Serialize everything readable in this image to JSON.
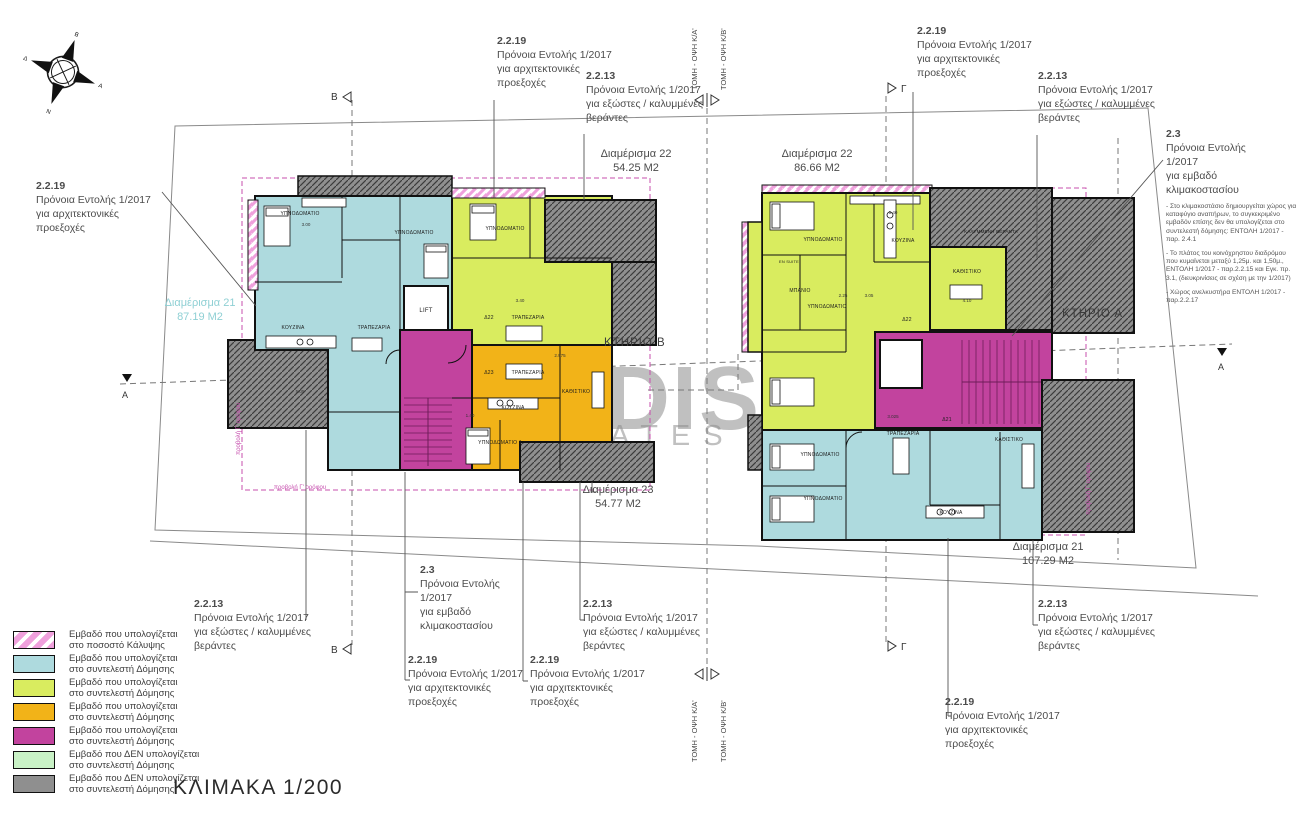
{
  "scale_label": "ΚΛΙΜΑΚΑ 1/200",
  "watermark": {
    "line1": "NDIS",
    "line2": "ATES"
  },
  "colors": {
    "teal": "#aedade",
    "lime": "#d9ec5f",
    "orange": "#f2b318",
    "magenta": "#c2439e",
    "light_green": "#c9f2c6",
    "gray": "#8f8f8f",
    "pink_hatch": "#efa0dc",
    "magenta_dash": "#c74fae",
    "teal_label": "#8fd0d4"
  },
  "compass": {
    "n": "Β",
    "e": "Α",
    "s": "Ν",
    "w": "Δ"
  },
  "buildings": {
    "left": "ΚΤΗΡΙΟ Β",
    "right": "ΚΤΗΡΙΟ Α"
  },
  "apartments": {
    "left_21": {
      "name": "Διαμέρισμα 21",
      "area": "87.19 M2"
    },
    "left_22": {
      "name": "Διαμέρισμα 22",
      "area": "54.25 M2"
    },
    "left_23": {
      "name": "Διαμέρισμα 23",
      "area": "54.77 M2"
    },
    "right_22": {
      "name": "Διαμέρισμα 22",
      "area": "86.66 M2"
    },
    "right_21": {
      "name": "Διαμέρισμα 21",
      "area": "107.29 M2"
    }
  },
  "annotations": {
    "a2219": {
      "code": "2.2.19",
      "lines": [
        "Πρόνοια Εντολής 1/2017",
        "για αρχιτεκτονικές",
        "προεξοχές"
      ]
    },
    "a2213": {
      "code": "2.2.13",
      "lines": [
        "Πρόνοια Εντολής 1/2017",
        "για εξώστες / καλυμμένες",
        "βεράντες"
      ]
    },
    "a23": {
      "code": "2.3",
      "lines": [
        "Πρόνοια Εντολής",
        "1/2017",
        "για εμβαδό",
        "κλιμακοστασίου"
      ]
    },
    "a23_notes": [
      "- Στο κλιμακοστάσιο δημιουργείται χώρος για καταφύγιο αναπήρων, το συγκεκριμένο εμβαδόν επίσης δεν θα υπολογίζεται στο συντελεστή δόμησης: ΕΝΤΟΛΗ 1/2017 - παρ. 2.4.1",
      "- Το πλάτος του κοινόχρηστου διαδρόμου που κυμαίνεται μεταξύ 1,25μ. και 1,50μ., ΕΝΤΟΛΗ 1/2017 - παρ.2.2.15 και Εγκ. πρ. 3.1, (διευκρινίσεις σε σχέση με την 1/2017)",
      "- Χώρος ανελκυστήρα ΕΝΤΟΛΗ 1/2017 - παρ.2.2.17"
    ]
  },
  "section_markers": {
    "b": "Β",
    "g": "Γ",
    "a": "Α",
    "tomi_ka": "ΤΟΜΗ - ΟΨΗ Κ/Α'",
    "tomi_kb": "ΤΟΜΗ - ΟΨΗ Κ/Β'"
  },
  "projection_label": "προβολή Γ' ορόφου",
  "rooms": [
    "ΥΠΝΟΔΩΜΑΤΙΟ",
    "ΥΠΝΟΔΩΜΑΤΙΟ",
    "ΚΟΥΖΙΝΑ",
    "ΤΡΑΠΕΖΑΡΙΑ",
    "ΥΠΝΟΔΩΜΑΤΙΟ",
    "Δ22",
    "ΤΡΑΠΕΖΑΡΙΑ",
    "Δ23",
    "ΤΡΑΠΕΖΑΡΙΑ",
    "ΚΟΥΖΙΝΑ",
    "ΚΑΘΙΣΤΙΚΟ",
    "ΥΠΝΟΔΩΜΑΤΙΟ 1",
    "LIFT",
    "ΥΠΝΟΔΩΜΑΤΙΟ",
    "ΜΠΑΝΙΟ",
    "ΥΠΝΟΔΩΜΑΤΙΟ",
    "ΚΟΥΖΙΝΑ",
    "ΚΑΘΙΣΤΙΚΟ",
    "Δ22",
    "LIFT",
    "ΥΠΝΟΔΩΜΑΤΙΟ",
    "ΥΠΝΟΔΩΜΑΤΙΟ",
    "ΤΡΑΠΕΖΑΡΙΑ",
    "ΚΑΘΙΣΤΙΚΟ",
    "ΚΟΥΖΙΝΑ",
    "Δ21",
    "ΚΑΛΥΜΜΕΝΗ ΒΕΡΑΝΤΑ",
    "EN SUITE"
  ],
  "dims": [
    "3.00",
    "5.40",
    "3.05",
    "4.10",
    "2.25",
    "3.025",
    "5.05",
    "3.40",
    "2.975",
    "1.40"
  ],
  "legend": {
    "items": [
      {
        "color": "hatch",
        "lines": [
          "Εμβαδό που υπολογίζεται",
          "στο ποσοστό Κάλυψης"
        ]
      },
      {
        "color": "#aedade",
        "lines": [
          "Εμβαδό που υπολογίζεται",
          "στο συντελεστή Δόμησης"
        ]
      },
      {
        "color": "#d9ec5f",
        "lines": [
          "Εμβαδό που υπολογίζεται",
          "στο συντελεστή Δόμησης"
        ]
      },
      {
        "color": "#f2b318",
        "lines": [
          "Εμβαδό που υπολογίζεται",
          "στο συντελεστή Δόμησης"
        ]
      },
      {
        "color": "#c2439e",
        "lines": [
          "Εμβαδό που υπολογίζεται",
          "στο συντελεστή Δόμησης"
        ]
      },
      {
        "color": "#c9f2c6",
        "lines": [
          "Εμβαδό που ΔΕΝ υπολογίζεται",
          "στο συντελεστή Δόμησης"
        ]
      },
      {
        "color": "#8f8f8f",
        "lines": [
          "Εμβαδό που ΔΕΝ υπολογίζεται",
          "στο συντελεστή Δόμησης"
        ]
      }
    ]
  }
}
